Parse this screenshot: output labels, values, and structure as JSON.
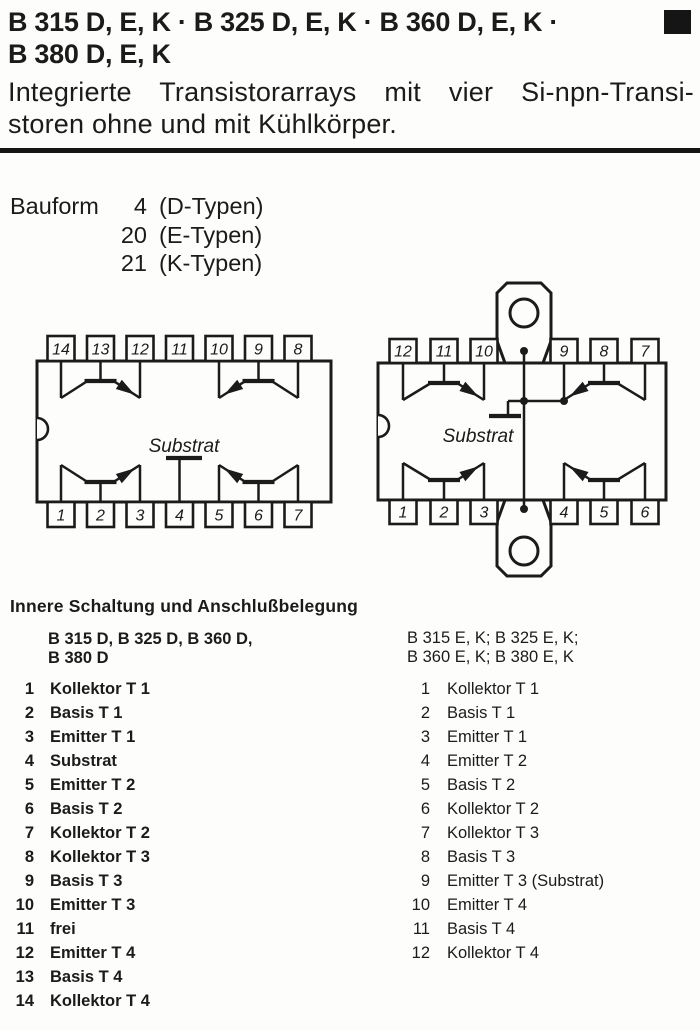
{
  "page": {
    "title_line1": "B 315 D, E, K · B 325 D, E, K · B 360 D, E, K ·",
    "title_line2": "B 380 D, E, K",
    "subtitle_line1": "Integrierte Transistorarrays mit vier Si-npn-Transi-",
    "subtitle_line2": "storen ohne und mit Kühlkörper."
  },
  "bauform": {
    "label": "Bauform",
    "rows": [
      {
        "number": "4",
        "type": "(D-Typen)"
      },
      {
        "number": "20",
        "type": "(E-Typen)"
      },
      {
        "number": "21",
        "type": "(K-Typen)"
      }
    ]
  },
  "diagrams": {
    "dip14": {
      "substrate_label": "Substrat",
      "top_pins": [
        "14",
        "13",
        "12",
        "11",
        "10",
        "9",
        "8"
      ],
      "bottom_pins": [
        "1",
        "2",
        "3",
        "4",
        "5",
        "6",
        "7"
      ]
    },
    "dip12": {
      "substrate_label": "Substrat",
      "top_pins": [
        "12",
        "11",
        "10",
        "9",
        "8",
        "7"
      ],
      "bottom_pins": [
        "1",
        "2",
        "3",
        "4",
        "5",
        "6"
      ]
    }
  },
  "pinout": {
    "heading": "Innere Schaltung und Anschlußbelegung",
    "left_column": {
      "header_line1": "B 315 D, B 325 D, B 360 D,",
      "header_line2": "B 380 D",
      "pins": [
        {
          "n": "1",
          "label": "Kollektor T 1"
        },
        {
          "n": "2",
          "label": "Basis T 1"
        },
        {
          "n": "3",
          "label": "Emitter T 1"
        },
        {
          "n": "4",
          "label": "Substrat"
        },
        {
          "n": "5",
          "label": "Emitter T 2"
        },
        {
          "n": "6",
          "label": "Basis T 2"
        },
        {
          "n": "7",
          "label": "Kollektor T 2"
        },
        {
          "n": "8",
          "label": "Kollektor T 3"
        },
        {
          "n": "9",
          "label": "Basis T 3"
        },
        {
          "n": "10",
          "label": "Emitter T 3"
        },
        {
          "n": "11",
          "label": "frei"
        },
        {
          "n": "12",
          "label": "Emitter T 4"
        },
        {
          "n": "13",
          "label": "Basis T 4"
        },
        {
          "n": "14",
          "label": "Kollektor T 4"
        }
      ]
    },
    "right_column": {
      "header_line1": "B 315 E, K; B 325 E, K;",
      "header_line2": "B 360 E, K; B 380 E, K",
      "pins": [
        {
          "n": "1",
          "label": "Kollektor T 1"
        },
        {
          "n": "2",
          "label": "Basis T 1"
        },
        {
          "n": "3",
          "label": "Emitter T 1"
        },
        {
          "n": "4",
          "label": "Emitter T 2"
        },
        {
          "n": "5",
          "label": "Basis T 2"
        },
        {
          "n": "6",
          "label": "Kollektor T 2"
        },
        {
          "n": "7",
          "label": "Kollektor T 3"
        },
        {
          "n": "8",
          "label": "Basis T 3"
        },
        {
          "n": "9",
          "label": "Emitter T 3 (Substrat)"
        },
        {
          "n": "10",
          "label": "Emitter T 4"
        },
        {
          "n": "11",
          "label": "Basis T 4"
        },
        {
          "n": "12",
          "label": "Kollektor T 4"
        }
      ]
    }
  },
  "colors": {
    "ink": "#1b1b1b",
    "paper": "#fdfdfb"
  }
}
